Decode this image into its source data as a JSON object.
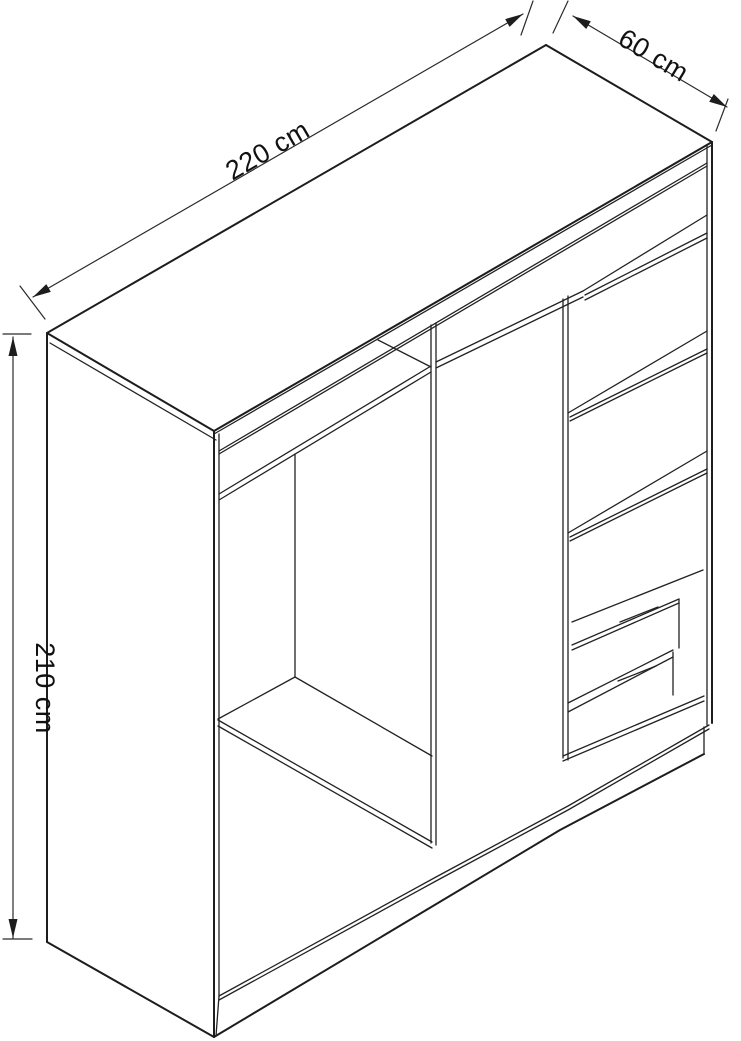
{
  "diagram": {
    "type": "furniture-dimension-wireframe",
    "subject": "wardrobe carcass, open front, isometric view",
    "dimensions": {
      "width_label": "220 cm",
      "depth_label": "60 cm",
      "height_label": "210 cm"
    },
    "visible_features": {
      "sections": 3,
      "drawers": 2,
      "right_section_shelves": 4,
      "left_section_low_shelf": 1,
      "full_width_top_shelf": 1
    }
  },
  "colors": {
    "background": "#ffffff",
    "line": "#1d1d1d",
    "dimension_line": "#2b2b2b",
    "label_text": "#111111"
  }
}
